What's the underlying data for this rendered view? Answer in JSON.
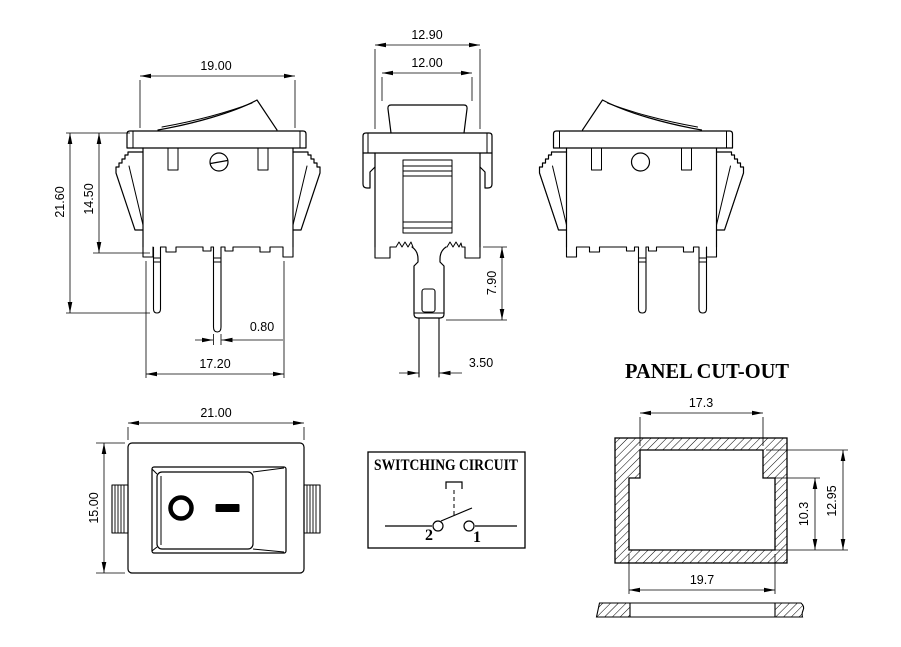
{
  "front_view": {
    "dim_width_top": "19.00",
    "dim_height_total": "21.60",
    "dim_height_body": "14.50",
    "dim_pin_width": "0.80",
    "dim_width_base": "17.20"
  },
  "side_view": {
    "dim_width_flange": "12.90",
    "dim_width_body": "12.00",
    "dim_terminal_length": "7.90",
    "dim_terminal_width": "3.50"
  },
  "top_view": {
    "dim_width": "21.00",
    "dim_height": "15.00",
    "marking_off": "O",
    "marking_on": "—"
  },
  "circuit": {
    "title": "SWITCHING CIRCUIT",
    "terminal_left": "2",
    "terminal_right": "1"
  },
  "panel_cutout": {
    "title": "PANEL CUT-OUT",
    "dim_top_width": "17.3",
    "dim_inner_height": "10.3",
    "dim_total_height": "12.95",
    "dim_bottom_width": "19.7"
  },
  "colors": {
    "line": "#000000",
    "background": "#ffffff"
  }
}
